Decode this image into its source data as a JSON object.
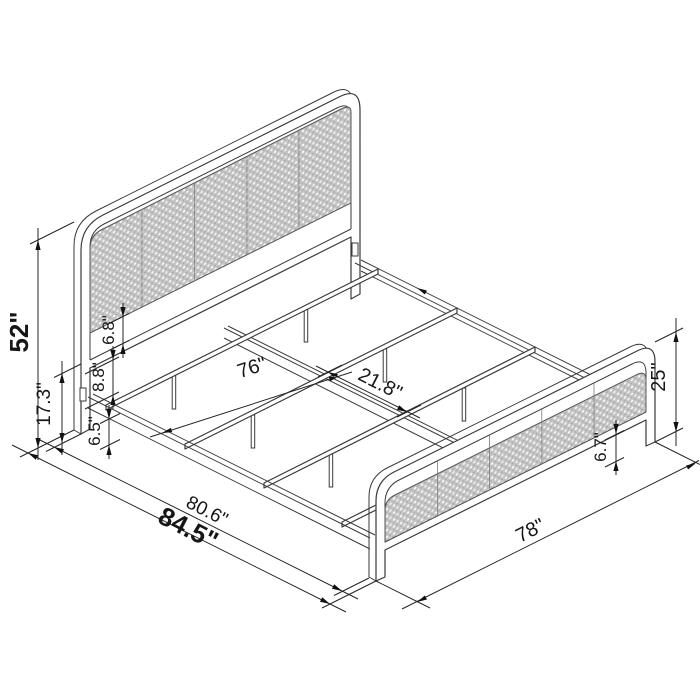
{
  "title": "Bed frame isometric dimension drawing",
  "colors": {
    "line": "#3a3a3a",
    "dimension": "#242424",
    "cane_fill": "#c3c3c3",
    "cane_dot": "#ffffff",
    "background": "#ffffff"
  },
  "labels": {
    "overall_height": "52\"",
    "rail_top_height": "17.3\"",
    "rail_to_panel": "8.8\"",
    "panel_gap": "6.8\"",
    "floor_clearance": "6.5\"",
    "slat_length": "76\"",
    "slat_spacing": "21.8\"",
    "frame_length": "80.6\"",
    "overall_length": "84.5\"",
    "overall_width": "78\"",
    "footboard_clearance": "6.7\"",
    "footboard_height": "25\""
  }
}
